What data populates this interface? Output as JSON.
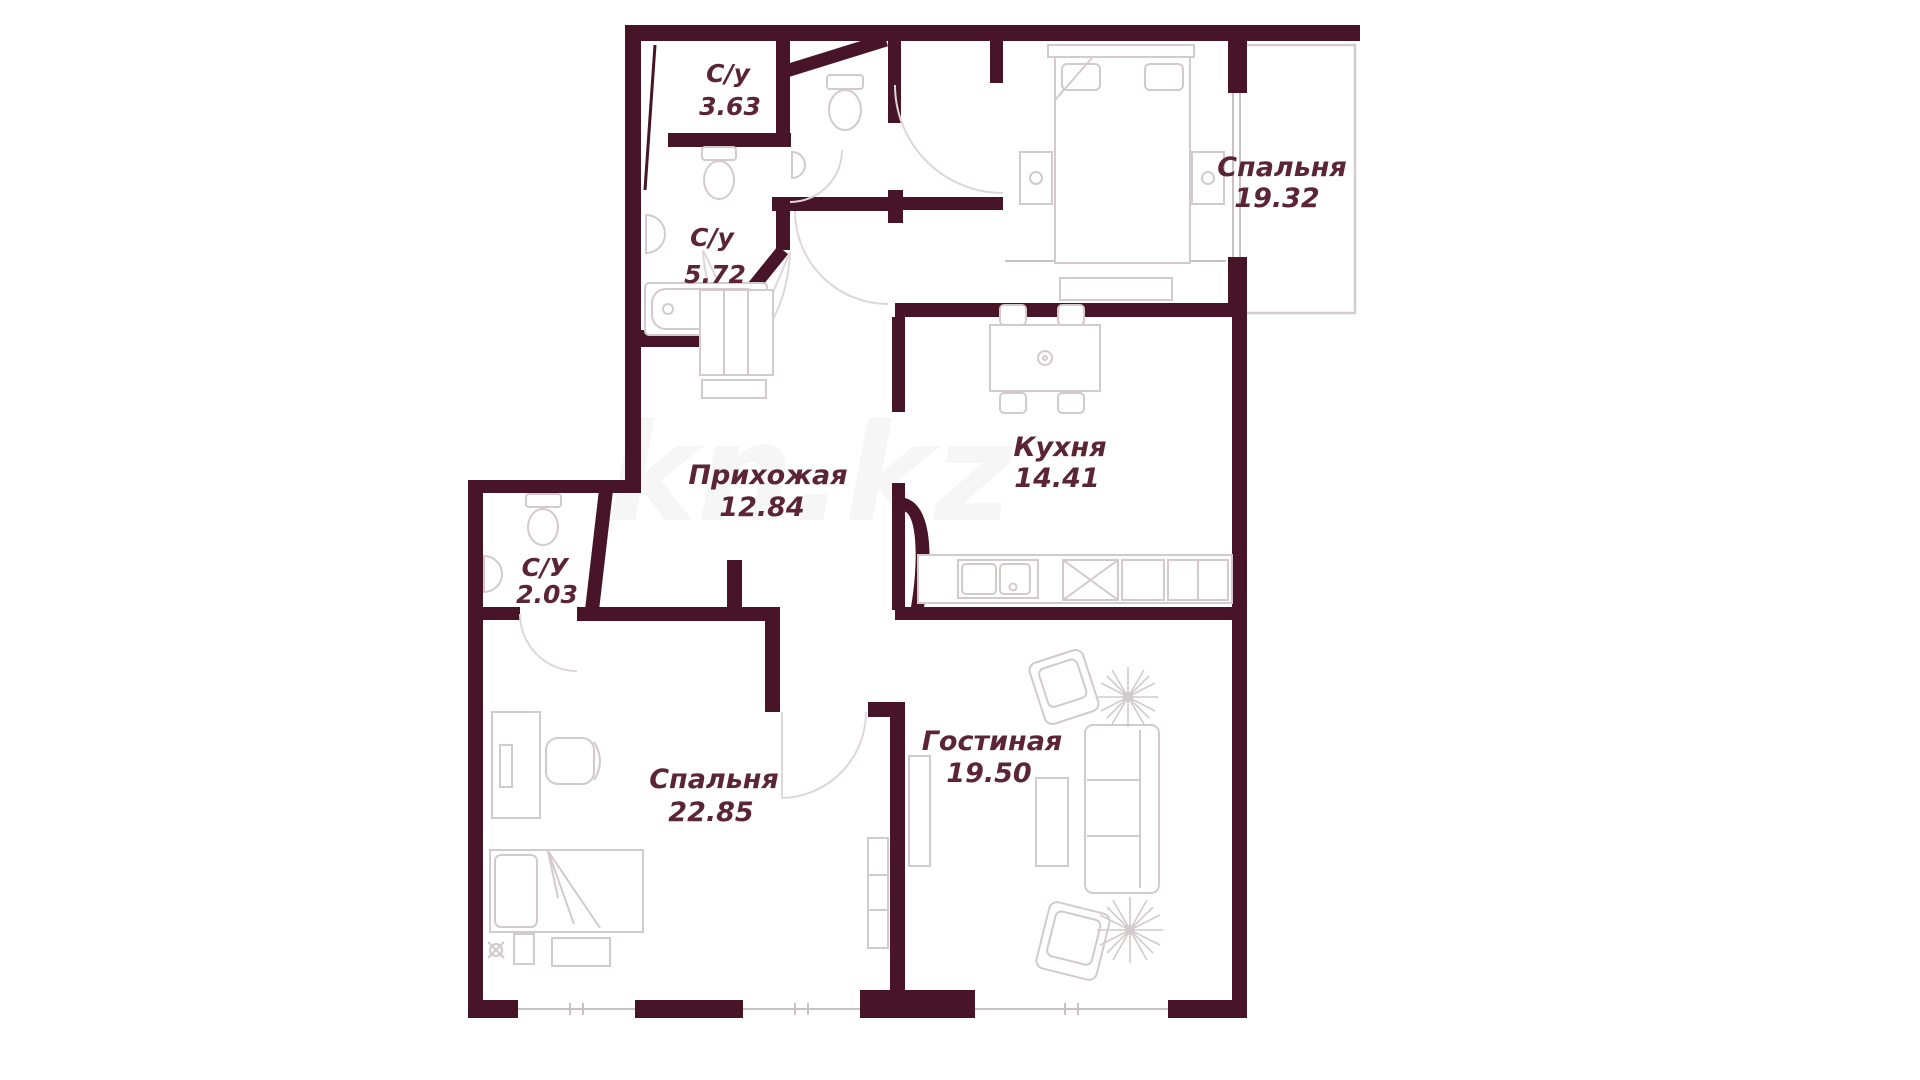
{
  "plan": {
    "watermark": "kn.kz",
    "colors": {
      "wall": "#471527",
      "furniture": "#d2cacb",
      "label": "#5c2535"
    },
    "rooms": [
      {
        "key": "bathroom-1",
        "name": "С/у",
        "area": "3.63"
      },
      {
        "key": "bathroom-2",
        "name": "С/у",
        "area": "5.72"
      },
      {
        "key": "bathroom-3",
        "name": "С/У",
        "area": "2.03"
      },
      {
        "key": "hallway",
        "name": "Прихожая",
        "area": "12.84"
      },
      {
        "key": "kitchen",
        "name": "Кухня",
        "area": "14.41"
      },
      {
        "key": "bedroom-1",
        "name": "Спальня",
        "area": "19.32"
      },
      {
        "key": "bedroom-2",
        "name": "Спальня",
        "area": "22.85"
      },
      {
        "key": "living-room",
        "name": "Гостиная",
        "area": "19.50"
      }
    ]
  }
}
